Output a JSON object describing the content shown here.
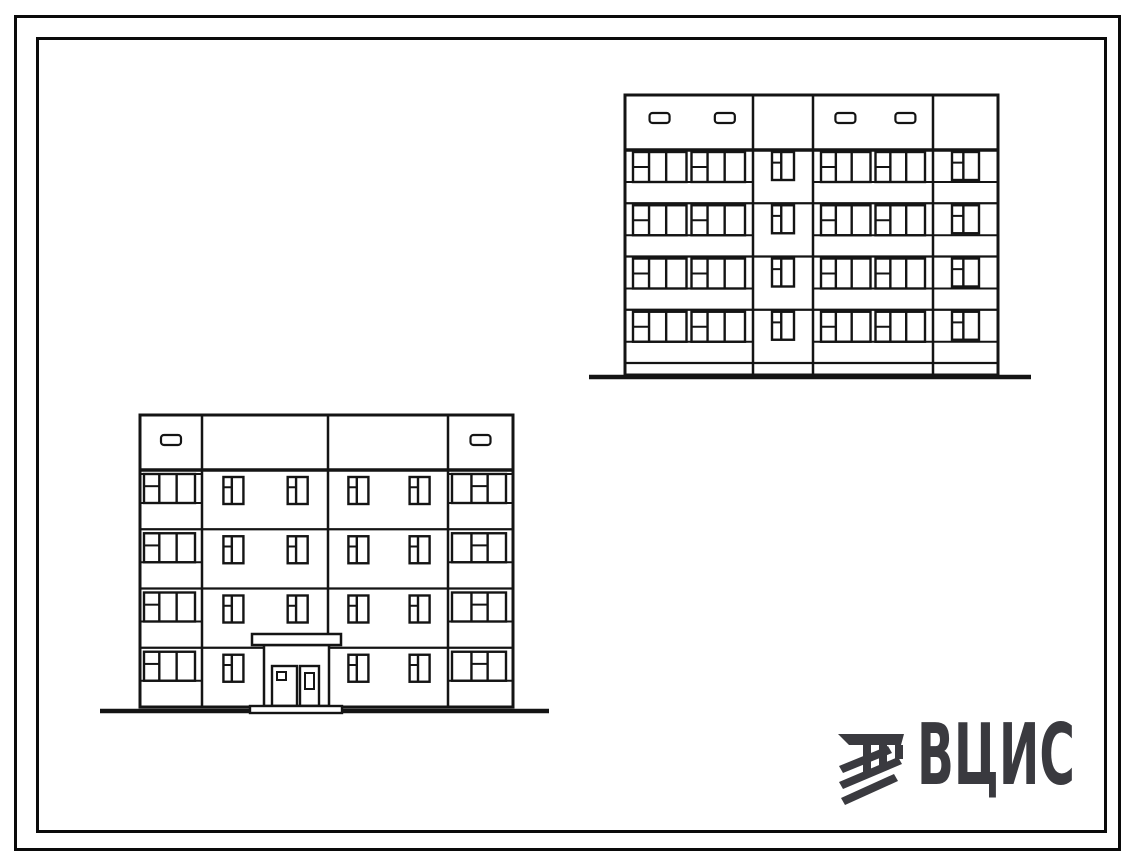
{
  "meta": {
    "description": "Line drawing of two facade elevations of a 4-storey typical-series apartment block, framed drawing sheet with VCIS watermark logo",
    "background": "#ffffff",
    "line_color": "#141414"
  },
  "frame": {
    "outer_stroke_px": 3,
    "inner_stroke_px": 3
  },
  "logo": {
    "text": "ВЦИС",
    "color": "#3a3a3f",
    "icon": "vcis-emblem-icon"
  },
  "drawing": {
    "window_styles": {
      "pair-group": {
        "mullions": [
          0.3,
          0.62
        ],
        "transom": {
          "pane": 0,
          "frac": 0.5
        }
      },
      "small": {
        "mullions": [
          0.42
        ],
        "transom": {
          "pane": 0,
          "frac": 0.38
        }
      },
      "balcony-left": {
        "mullions": [
          0.3,
          0.64
        ],
        "transom": {
          "pane": 0,
          "frac": 0.42
        }
      },
      "balcony-right": {
        "mullions": [
          0.36,
          0.66
        ],
        "transom": {
          "pane": 1,
          "frac": 0.42
        }
      }
    },
    "elevations": [
      {
        "id": "elevation-rear",
        "storeys": 4,
        "x": 625,
        "y": 95,
        "width": 373,
        "wall_height": 280,
        "attic_height": 55,
        "floors": 4,
        "floor_zone_height": 213,
        "plinth_line": 363,
        "vent_y": 113,
        "vent_w": 20,
        "vent_h": 10,
        "sections": [
          {
            "width": 128,
            "type": "balcony-pair",
            "vents": [
              0.27,
              0.78
            ]
          },
          {
            "width": 60,
            "type": "stairwell"
          },
          {
            "width": 120,
            "type": "balcony-pair",
            "vents": [
              0.27,
              0.77
            ]
          },
          {
            "width": 65,
            "type": "end-window"
          }
        ],
        "ground_line": {
          "x1": 589,
          "y": 377,
          "x2": 1031,
          "thickness": 4.5
        }
      },
      {
        "id": "elevation-front-entrance",
        "storeys": 4,
        "x": 140,
        "y": 415,
        "width": 373,
        "wall_height": 292,
        "attic_height": 55,
        "floors": 4,
        "floor_zone_height": 237,
        "vent_y": 435,
        "vent_w": 20,
        "vent_h": 10,
        "attic_extra": [
          [
            140,
            202
          ],
          [
            448,
            513
          ]
        ],
        "sections": [
          {
            "width": 62,
            "type": "balcony-single",
            "style": "balcony-left",
            "vents": [
              0.5
            ]
          },
          {
            "width": 126,
            "type": "wide-pair",
            "entrance_floor": 3,
            "skip": 1
          },
          {
            "width": 120,
            "type": "wide-pair"
          },
          {
            "width": 65,
            "type": "balcony-single",
            "style": "balcony-right",
            "vents": [
              0.5
            ]
          }
        ],
        "entrance": {
          "canopy": {
            "x": 252,
            "y": 634,
            "w": 89,
            "h": 11
          },
          "porch": {
            "x": 264,
            "y": 645,
            "w": 65,
            "h": 61
          },
          "doors": [
            {
              "x": 272,
              "y": 666,
              "w": 25,
              "h": 40,
              "pane": {
                "x": 277,
                "y": 672,
                "w": 9,
                "h": 8
              }
            },
            {
              "x": 300,
              "y": 666,
              "w": 19,
              "h": 40,
              "pane": {
                "x": 305,
                "y": 673,
                "w": 9,
                "h": 16
              }
            }
          ],
          "step": {
            "x": 250,
            "y": 706,
            "w": 92,
            "h": 7
          }
        },
        "ground_line": {
          "x1": 100,
          "y": 711,
          "x2": 549,
          "thickness": 4.5
        }
      }
    ]
  }
}
